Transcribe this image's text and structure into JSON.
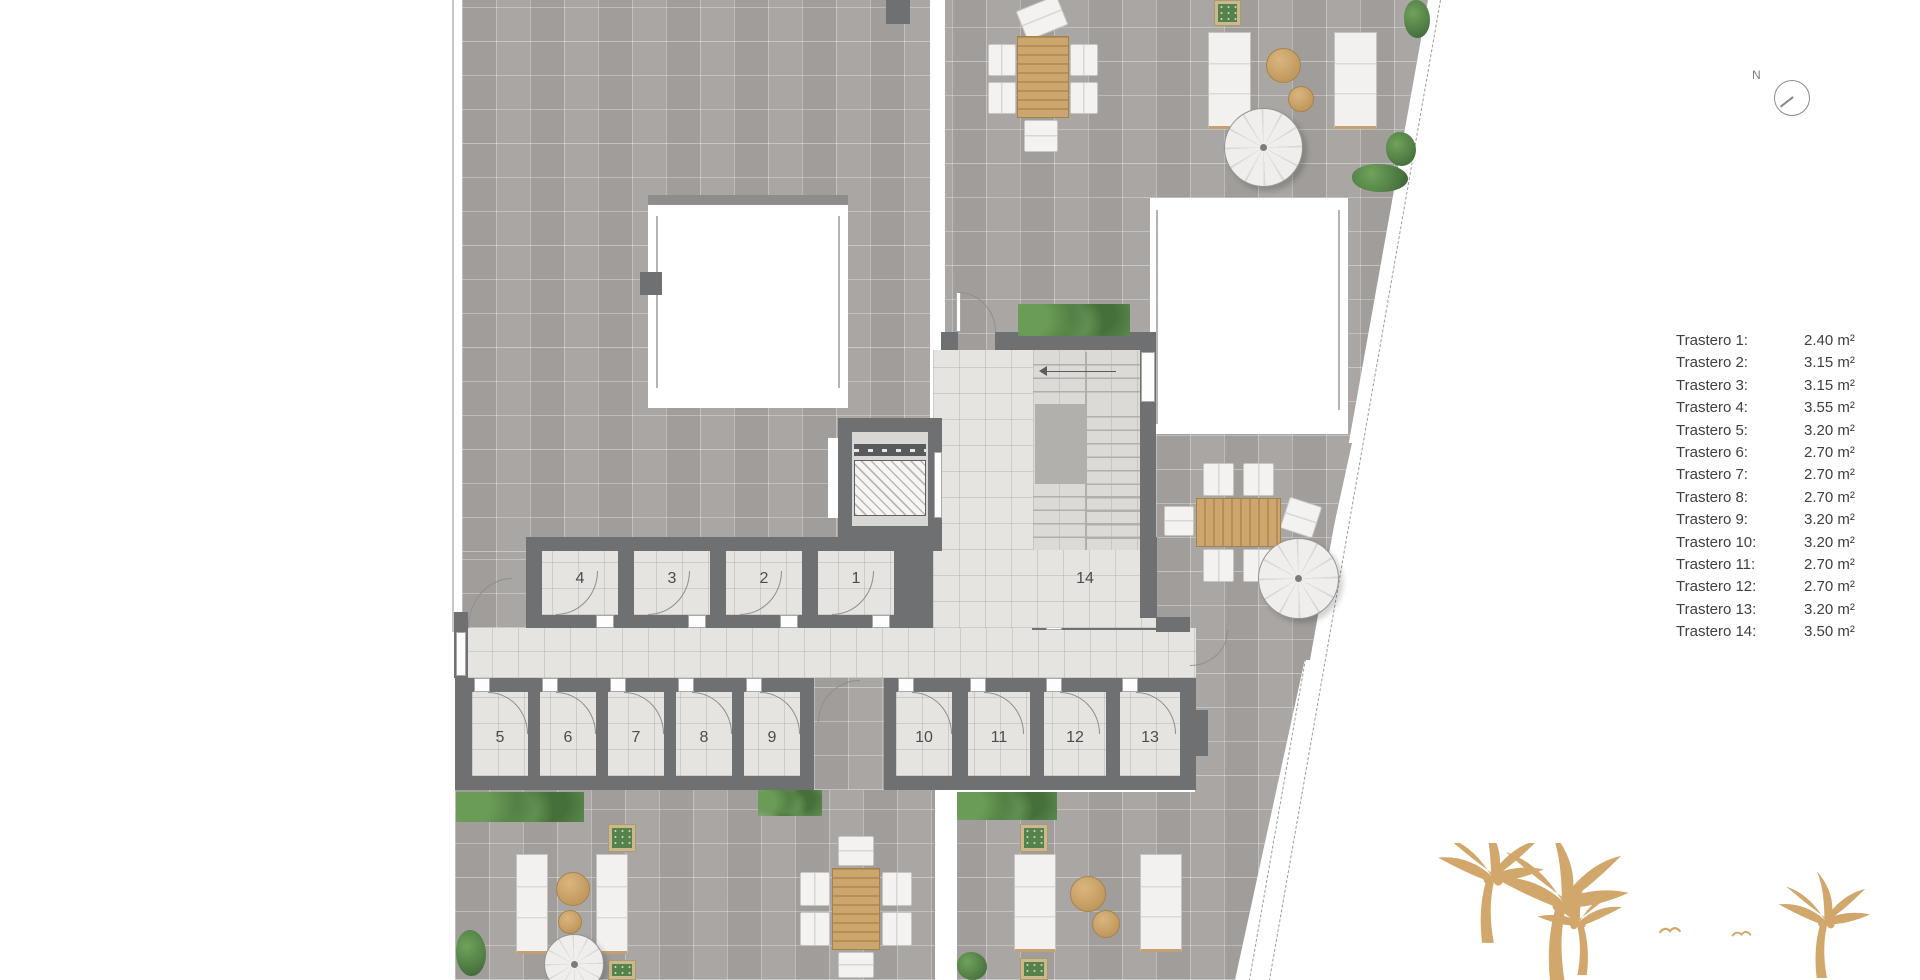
{
  "compass": {
    "label": "N"
  },
  "legend": {
    "items": [
      {
        "label": "Trastero 1:",
        "value": "2.40 m²"
      },
      {
        "label": "Trastero 2:",
        "value": "3.15 m²"
      },
      {
        "label": "Trastero 3:",
        "value": "3.15 m²"
      },
      {
        "label": "Trastero 4:",
        "value": "3.55 m²"
      },
      {
        "label": "Trastero 5:",
        "value": "3.20 m²"
      },
      {
        "label": "Trastero 6:",
        "value": "2.70 m²"
      },
      {
        "label": "Trastero 7:",
        "value": "2.70 m²"
      },
      {
        "label": "Trastero 8:",
        "value": "2.70 m²"
      },
      {
        "label": "Trastero 9:",
        "value": "3.20 m²"
      },
      {
        "label": "Trastero 10:",
        "value": "3.20 m²"
      },
      {
        "label": "Trastero 11:",
        "value": "2.70 m²"
      },
      {
        "label": "Trastero 12:",
        "value": "2.70 m²"
      },
      {
        "label": "Trastero 13:",
        "value": "3.20 m²"
      },
      {
        "label": "Trastero 14:",
        "value": "3.50 m²"
      }
    ]
  },
  "rooms": {
    "top": [
      "4",
      "3",
      "2",
      "1",
      "14"
    ],
    "bottom": [
      "5",
      "6",
      "7",
      "8",
      "9",
      "10",
      "11",
      "12",
      "13"
    ]
  },
  "colors": {
    "wall": "#6e7072",
    "terrace": "#a6a3a0",
    "corridor": "#e5e4e1",
    "wood": "#c9a36e",
    "greenery": "#517e43",
    "palm": "#d2a76b",
    "parasol": "#efeeec"
  }
}
